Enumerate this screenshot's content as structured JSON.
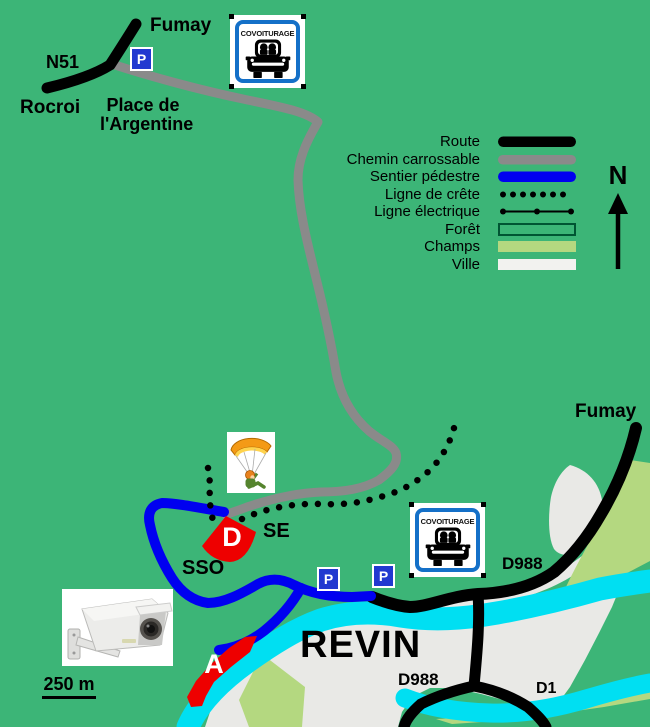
{
  "title": "Carte du site de vol libre de Revin",
  "labels": {
    "fumay_top": "Fumay",
    "n51": "N51",
    "rocroi": "Rocroi",
    "place_line1": "Place de",
    "place_line2": "l'Argentine",
    "fumay_right": "Fumay",
    "d988_upper": "D988",
    "d988_lower": "D988",
    "d1": "D1",
    "revin": "REVIN",
    "se": "SE",
    "sso": "SSO",
    "takeoff": "D",
    "landing": "A",
    "north": "N",
    "scale": "250 m"
  },
  "legend": {
    "items": [
      {
        "label": "Route",
        "type": "black-bar"
      },
      {
        "label": "Chemin carrossable",
        "type": "gray-bar"
      },
      {
        "label": "Sentier pédestre",
        "type": "blue-bar"
      },
      {
        "label": "Ligne de crête",
        "type": "dotted-line"
      },
      {
        "label": "Ligne électrique",
        "type": "line-with-dots"
      },
      {
        "label": "Forêt",
        "type": "outlined-box"
      },
      {
        "label": "Champs",
        "type": "light-green-bar"
      },
      {
        "label": "Ville",
        "type": "white-bar"
      }
    ]
  },
  "signs": {
    "covoiturage": "COVOITURAGE",
    "parking": "P"
  },
  "colors": {
    "background": "#3cb577",
    "route": "#000000",
    "track": "#8a8a8a",
    "footpath": "#0000f0",
    "ridge": "#000000",
    "electric": "#000000",
    "forest_outline": "#005533",
    "fields": "#b4d880",
    "town": "#e9e9e6",
    "town_swatch": "#f2f2ef",
    "river": "#00dff2",
    "marker_red": "#ee0000",
    "sign_blue": "#1470c8",
    "parking_blue": "#2239d0"
  }
}
